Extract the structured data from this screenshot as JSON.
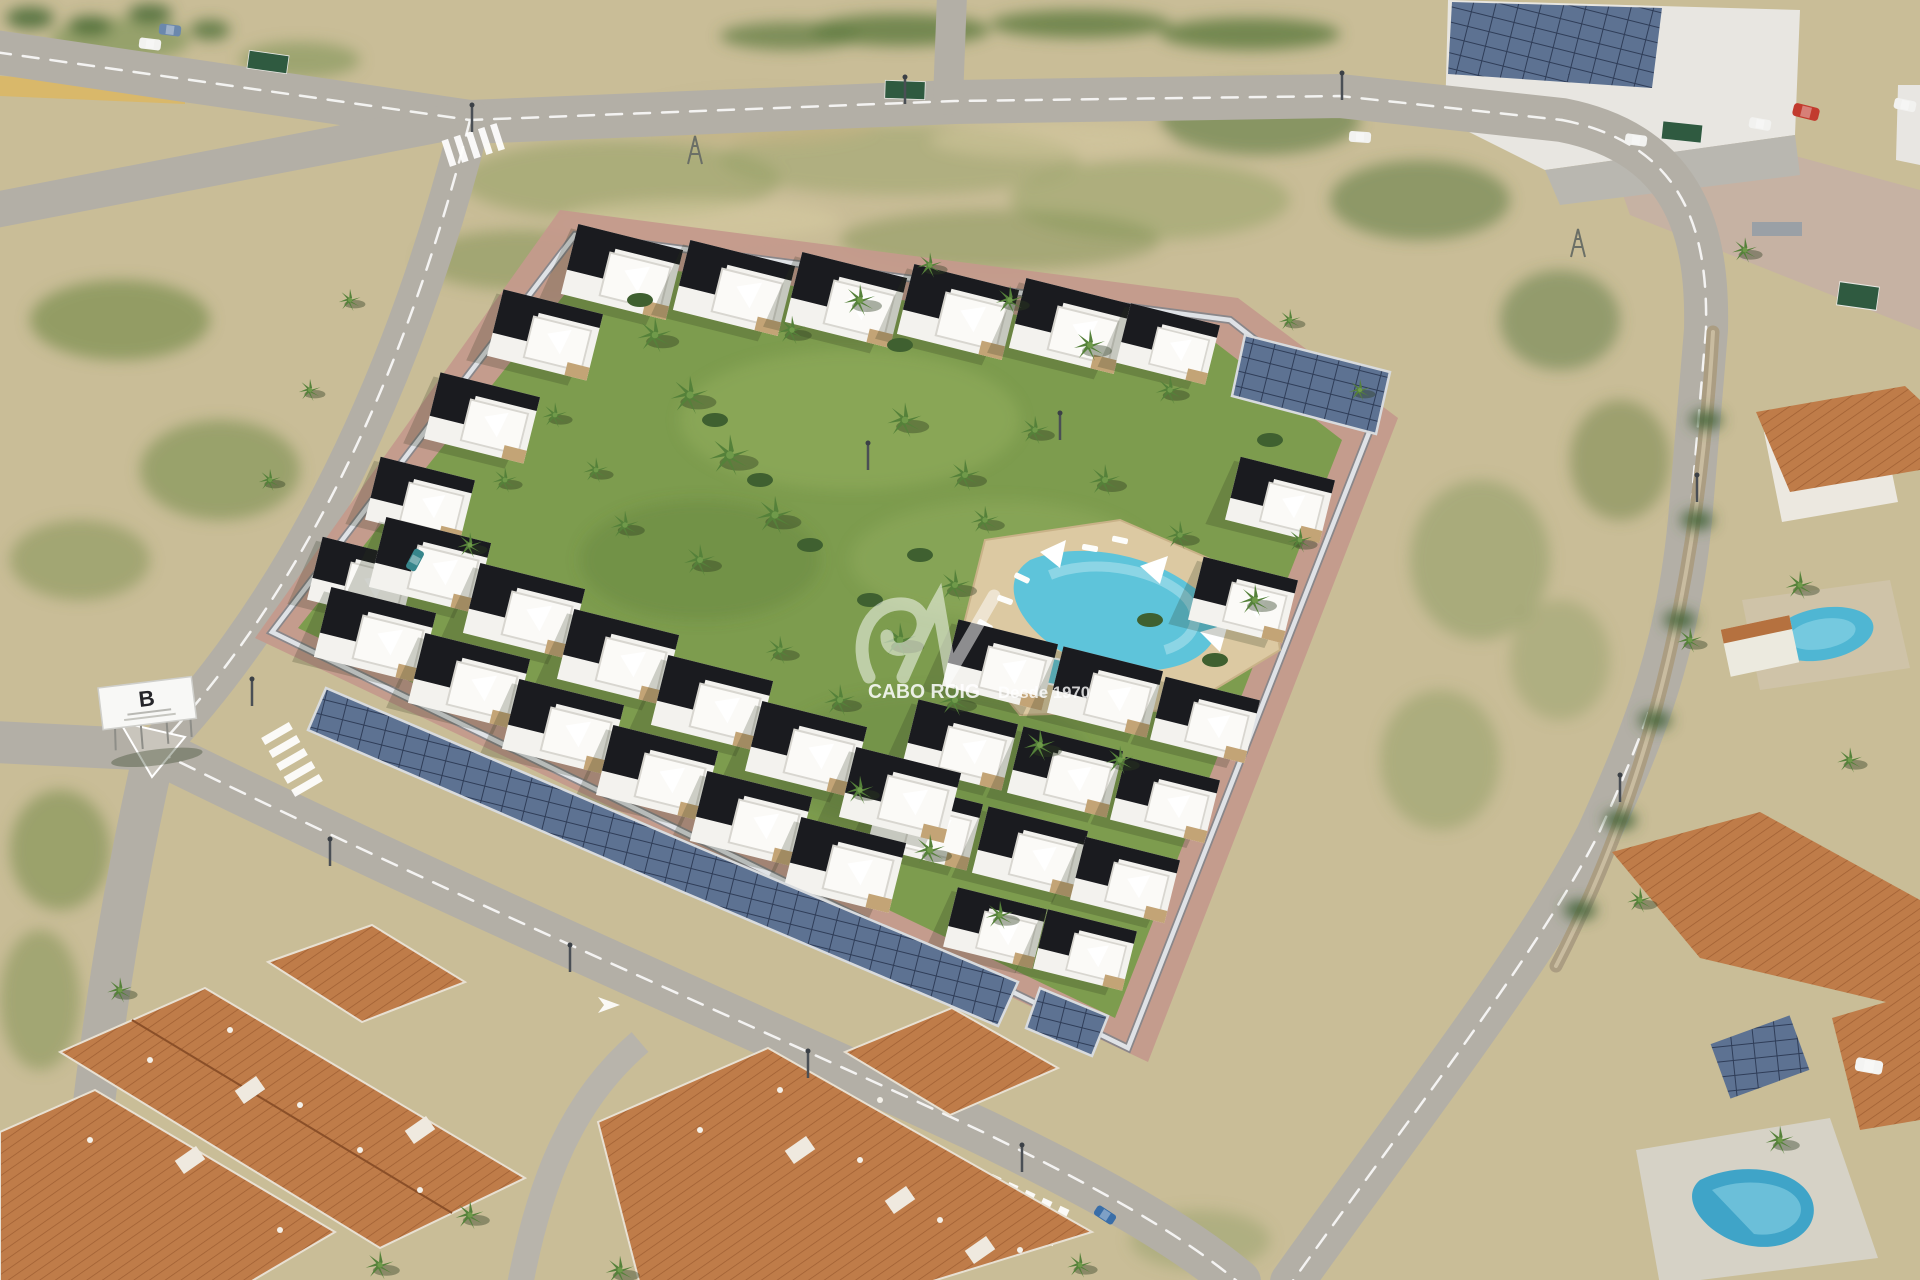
{
  "scene": {
    "type": "aerial-architectural-render",
    "watermark": {
      "brand": "CABO ROIG",
      "tagline": "Desde 1970"
    },
    "billboard": {
      "letter": "B"
    }
  },
  "palette": {
    "scrub": "#c9bd97",
    "scrub_green": "#7d904f",
    "road": "#b3afa6",
    "sidewalk_pink": "#c49a8c",
    "lawn": "#7d9c4e",
    "building_white": "#f3f2ee",
    "roof_dark": "#1a1b1f",
    "terracotta": "#bf7c49",
    "pool_turquoise": "#5ec4da",
    "pool_deck": "#dcc9a2",
    "solar_panel": "#5d7292",
    "wall_light": "#dfe2e6",
    "watermark_white": "#ffffff"
  }
}
